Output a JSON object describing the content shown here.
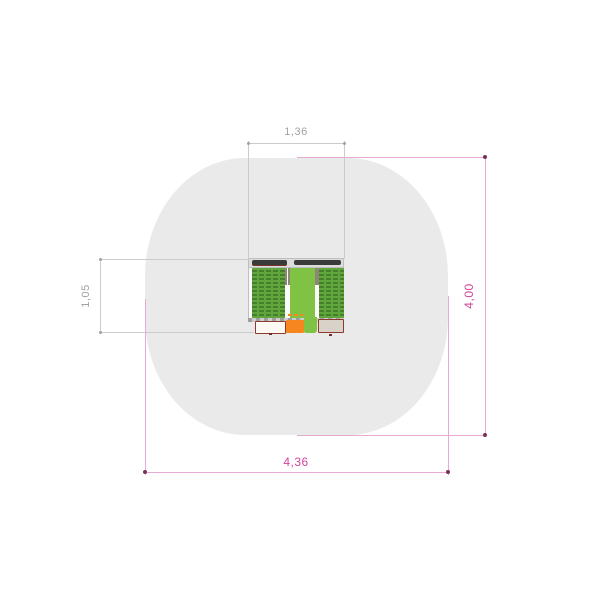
{
  "dimensions": {
    "equipment_width": {
      "label": "1,36"
    },
    "equipment_depth": {
      "label": "1,05"
    },
    "safety_area_height": {
      "label": "4,00"
    },
    "safety_area_width": {
      "label": "4,36"
    }
  },
  "colors": {
    "background": "#ffffff",
    "safety-area": "#eaeaea",
    "dim-gray-line": "#cbcbcb",
    "dim-gray-text": "#a2a2a2",
    "dim-pink-line": "#e6abd2",
    "dim-pink-text": "#d0459b",
    "dim-pink-dot": "#7d3058",
    "frame-gray": "#dcdcdc",
    "frame-border": "#bfbfbf",
    "bar-dark": "#3a3a3a",
    "bar-underline": "#7a3328",
    "panel-green": "#60a63c",
    "panel-green-dark": "#467f2b",
    "panel-light-green": "#80c243",
    "post-gray": "#8d8578",
    "beam-gray": "#cdcdcd",
    "beam-dash": "#9e9e9e",
    "orange": "#f6861f",
    "box-border": "#8c3b2e",
    "box-white": "#fcf9f5",
    "box-beige": "#d9d2c8",
    "foot-dark": "#6e2d22"
  }
}
